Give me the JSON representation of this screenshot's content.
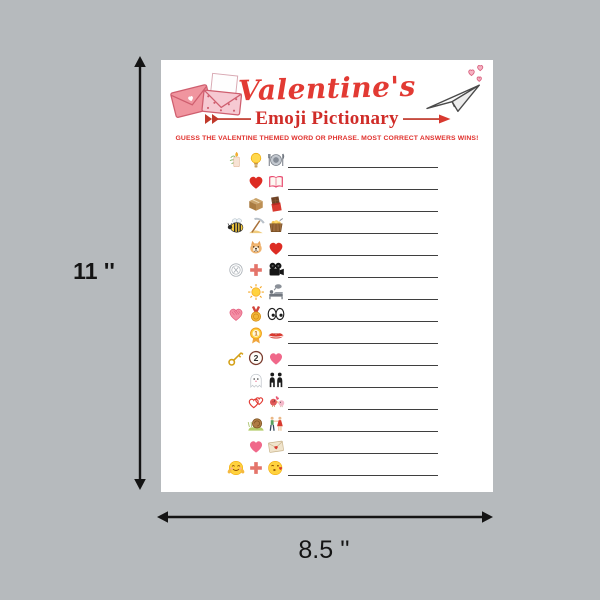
{
  "mockup": {
    "height_label": "11 ''",
    "width_label": "8.5 ''"
  },
  "card": {
    "title": "Valentine's",
    "subtitle": "Emoji Pictionary",
    "instructions": "GUESS THE VALENTINE THEMED WORD OR PHRASE. MOST CORRECT ANSWERS WINS!",
    "decor": {
      "top_left": "love-letter-envelopes-illustration",
      "top_right": "paper-plane-with-hearts-illustration"
    },
    "colors": {
      "title_red": "#e23a33",
      "subtitle_red": "#d02c28",
      "instruction_red": "#e0302c",
      "cupid_arrow_red": "#c0392b",
      "answer_line_gray": "#3f3f3f",
      "background_gray": "#b6babd",
      "paper_white": "#ffffff"
    },
    "icon_text": {
      "first_place": "1",
      "number_two": "2"
    },
    "puzzles": [
      {
        "num": 1,
        "emojis": [
          "candle",
          "light-bulb",
          "plate-cutlery"
        ]
      },
      {
        "num": 2,
        "emojis": [
          "red-heart",
          "open-book"
        ]
      },
      {
        "num": 3,
        "emojis": [
          "package-box",
          "chocolate-bar"
        ]
      },
      {
        "num": 4,
        "emojis": [
          "bee",
          "pickaxe",
          "gold-cart"
        ]
      },
      {
        "num": 5,
        "emojis": [
          "puppy",
          "red-heart"
        ]
      },
      {
        "num": 6,
        "emojis": [
          "dinner-plate-outline",
          "plus",
          "movie-camera"
        ]
      },
      {
        "num": 7,
        "emojis": [
          "sun",
          "person-in-bed"
        ]
      },
      {
        "num": 8,
        "emojis": [
          "scribble-heart",
          "medal",
          "eyes"
        ]
      },
      {
        "num": 9,
        "emojis": [
          "first-place-rosette",
          "kiss-lips"
        ]
      },
      {
        "num": 10,
        "emojis": [
          "key",
          "number-two",
          "pink-heart"
        ]
      },
      {
        "num": 11,
        "emojis": [
          "ghost",
          "couple"
        ]
      },
      {
        "num": 12,
        "emojis": [
          "linked-hearts",
          "love-birds"
        ]
      },
      {
        "num": 13,
        "emojis": [
          "snail",
          "dancing-couple"
        ]
      },
      {
        "num": 14,
        "emojis": [
          "pink-heart",
          "love-letter"
        ]
      },
      {
        "num": 15,
        "emojis": [
          "hugging-face",
          "plus",
          "kissing-face"
        ]
      }
    ]
  }
}
